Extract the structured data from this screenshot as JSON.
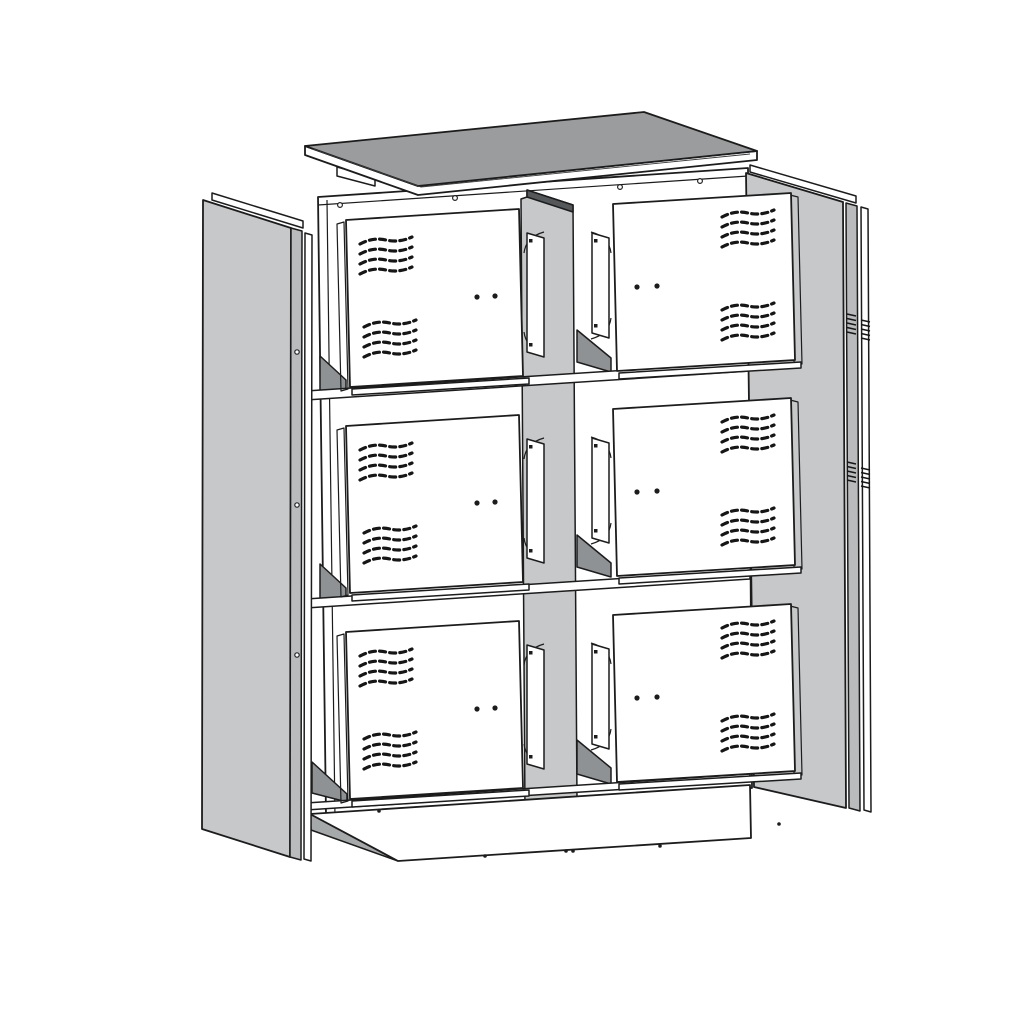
{
  "page": {
    "background_color": "#ffffff"
  },
  "diagram": {
    "type": "exploded-view-technical-drawing",
    "subject": "Exploded view of a two-column, three-tier metal cabinet with six ventilated doors",
    "colors": {
      "background": "#ffffff",
      "outline": "#1c1c1c",
      "panel_gray": "#c6c8c9",
      "panel_gray_dark": "#b9bbbc",
      "top_face_gray": "#9a9c9d",
      "shelf_gray": "#8f9294",
      "plinth_side_gray": "#a6a9aa",
      "divider_edge_dark": "#55585a",
      "door_white": "#ffffff"
    },
    "components": {
      "top_panel": "top panel",
      "left_side_panel": "left side panel",
      "right_side_panel": "right side panel",
      "back_panel": "back panel",
      "center_divider": "center divider",
      "shelf": "shelf",
      "base_plinth": "base plinth",
      "door": "ventilated door"
    },
    "door_grid": {
      "rows": 3,
      "columns": 2,
      "door_count": 6,
      "vent_clusters_per_door": 2,
      "vent_rows_per_cluster": 4,
      "holes_per_door": 2
    }
  }
}
